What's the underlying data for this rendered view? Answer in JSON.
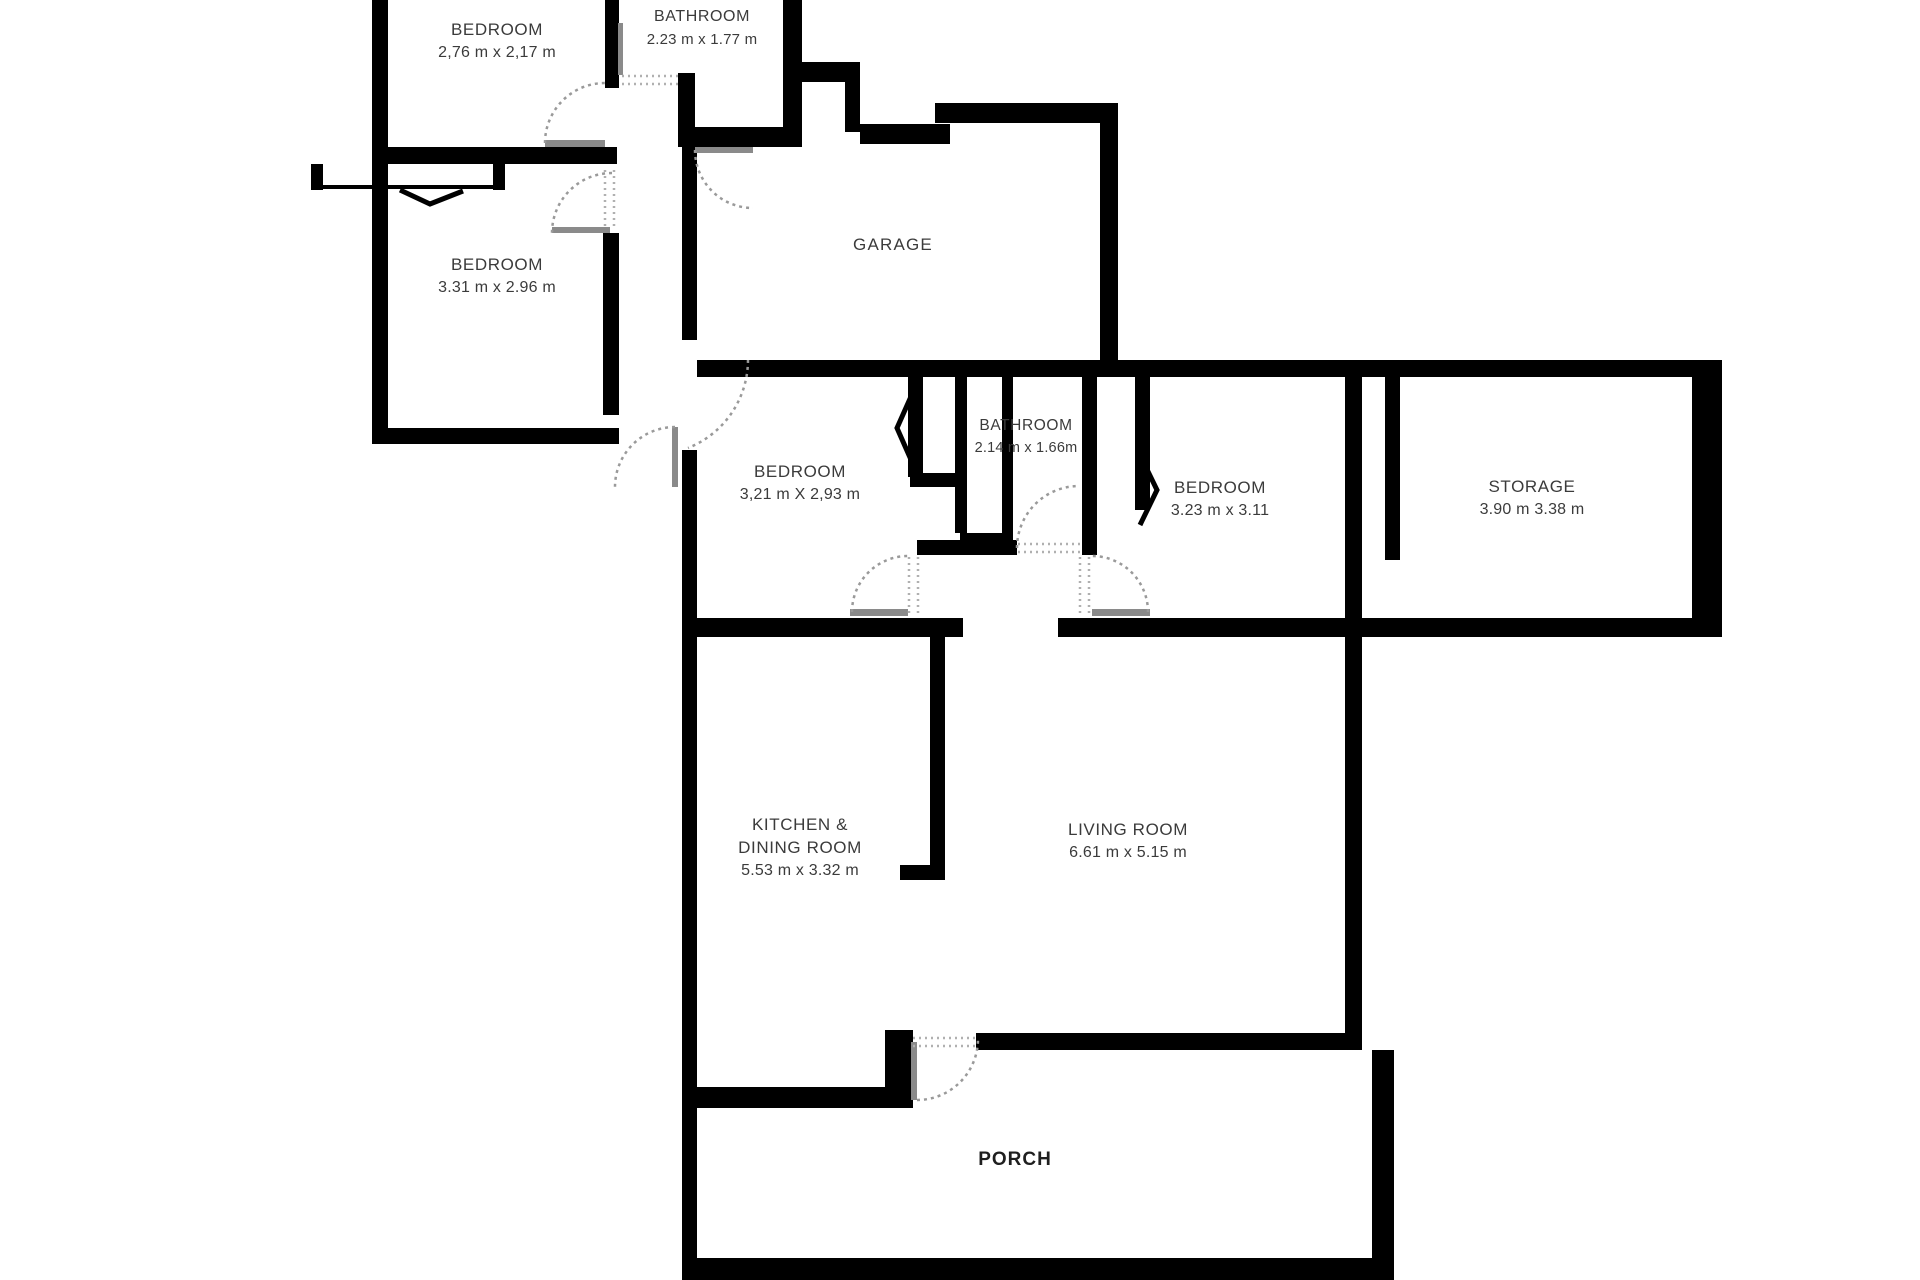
{
  "colors": {
    "wall": "#000000",
    "door_leaf": "#8a8a8a",
    "door_arc": "#9a9a9a",
    "label_text": "#3b3b3b",
    "background": "#ffffff"
  },
  "rooms": [
    {
      "id": "bedroom-1",
      "line1": "BEDROOM",
      "line2": "2,76 m x 2,17 m",
      "line3": "",
      "x": 497,
      "y": 18
    },
    {
      "id": "bathroom-1",
      "line1": "BATHROOM",
      "line2": "2.23 m x 1.77 m",
      "line3": "",
      "x": 702,
      "y": 5
    },
    {
      "id": "bedroom-2",
      "line1": "BEDROOM",
      "line2": "3.31 m x 2.96 m",
      "line3": "",
      "x": 497,
      "y": 253
    },
    {
      "id": "garage",
      "line1": "GARAGE",
      "line2": "",
      "line3": "",
      "x": 893,
      "y": 233
    },
    {
      "id": "bedroom-3",
      "line1": "BEDROOM",
      "line2": "3,21 m X 2,93 m",
      "line3": "",
      "x": 800,
      "y": 460
    },
    {
      "id": "bathroom-2",
      "line1": "BATHROOM",
      "line2": "2.14 m x 1.66m",
      "line3": "",
      "x": 1026,
      "y": 414
    },
    {
      "id": "bedroom-4",
      "line1": "BEDROOM",
      "line2": "3.23 m x 3.11",
      "line3": "",
      "x": 1220,
      "y": 476
    },
    {
      "id": "storage",
      "line1": "STORAGE",
      "line2": "3.90 m 3.38 m",
      "line3": "",
      "x": 1532,
      "y": 475
    },
    {
      "id": "kitchen",
      "line1": "KITCHEN &",
      "line2": "DINING ROOM",
      "line3": "5.53 m x 3.32 m",
      "x": 800,
      "y": 813
    },
    {
      "id": "living-room",
      "line1": "LIVING ROOM",
      "line2": "6.61 m x 5.15 m",
      "line3": "",
      "x": 1128,
      "y": 818
    },
    {
      "id": "porch",
      "line1": "PORCH",
      "line2": "",
      "line3": "",
      "x": 1015,
      "y": 1148
    }
  ]
}
